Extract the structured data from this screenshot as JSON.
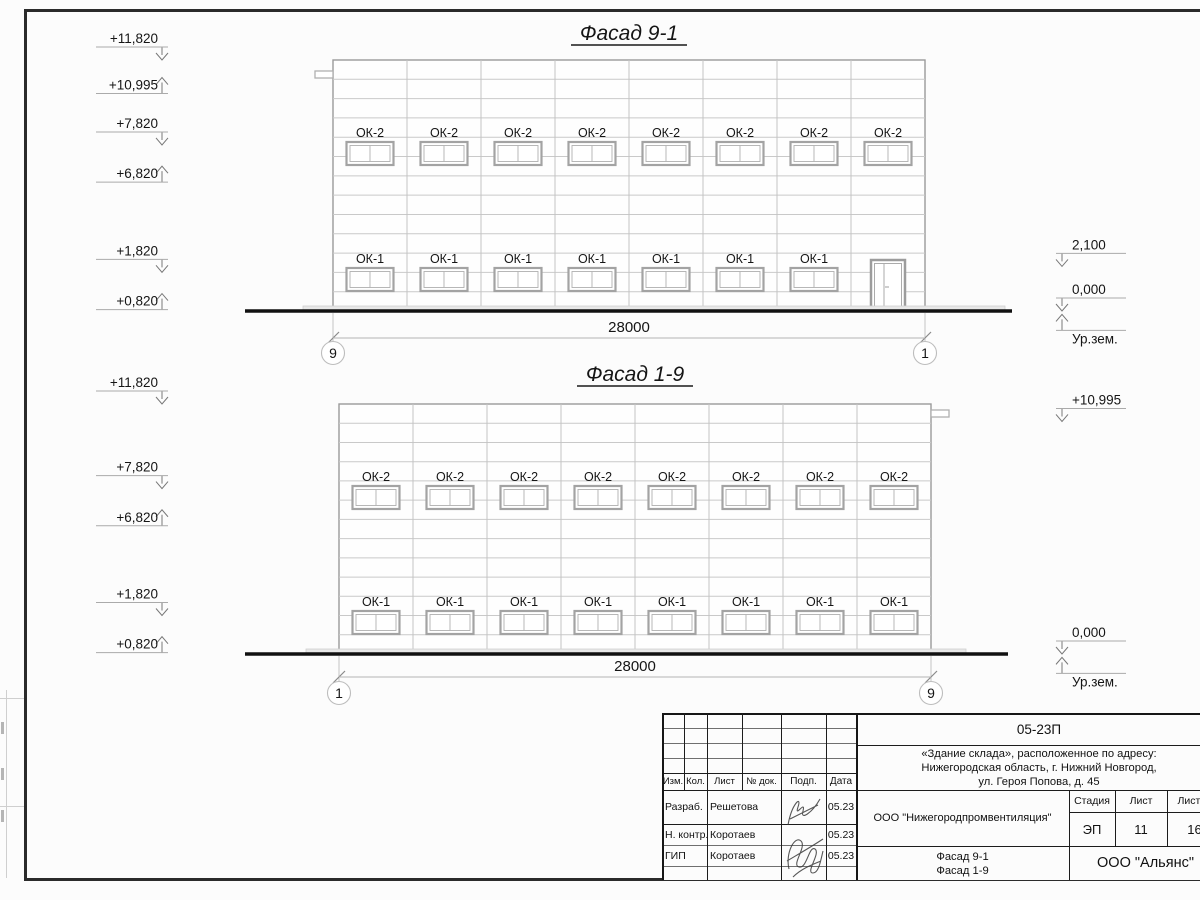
{
  "sheet": {
    "background": "#fcfcfc",
    "line_color": "#1c1c1c",
    "light_line_color": "#c9c9c9"
  },
  "facades": [
    {
      "title": "Фасад 9-1",
      "dimension": "28000",
      "axis_left": "9",
      "axis_right": "1",
      "bays": 8,
      "upper_window_label": "ОК-2",
      "upper_window_count": 8,
      "lower_window_label": "ОК-1",
      "lower_window_count": 7,
      "door_in_last_bay": true,
      "tab_side": "left",
      "levels_left": [
        {
          "text": "+11,820",
          "dir": "down",
          "mm": 11820
        },
        {
          "text": "+10,995",
          "dir": "up",
          "mm": 10995
        },
        {
          "text": "+7,820",
          "dir": "down",
          "mm": 7820
        },
        {
          "text": "+6,820",
          "dir": "up",
          "mm": 6820
        },
        {
          "text": "+1,820",
          "dir": "down",
          "mm": 1820
        },
        {
          "text": "+0,820",
          "dir": "up",
          "mm": 820
        }
      ],
      "levels_right": [
        {
          "text": "2,100",
          "dir": "down",
          "mm": 2100
        },
        {
          "text": "0,000",
          "dir": "down",
          "mm": 0
        },
        {
          "text": "Ур.зем.",
          "dir": "up",
          "mm": -160,
          "text_below": true
        }
      ]
    },
    {
      "title": "Фасад 1-9",
      "dimension": "28000",
      "axis_left": "1",
      "axis_right": "9",
      "bays": 8,
      "upper_window_label": "ОК-2",
      "upper_window_count": 8,
      "lower_window_label": "ОК-1",
      "lower_window_count": 8,
      "door_in_last_bay": false,
      "tab_side": "right",
      "levels_left": [
        {
          "text": "+11,820",
          "dir": "down",
          "mm": 11820
        },
        {
          "text": "+7,820",
          "dir": "down",
          "mm": 7820
        },
        {
          "text": "+6,820",
          "dir": "up",
          "mm": 6820
        },
        {
          "text": "+1,820",
          "dir": "down",
          "mm": 1820
        },
        {
          "text": "+0,820",
          "dir": "up",
          "mm": 820
        }
      ],
      "levels_right": [
        {
          "text": "+10,995",
          "dir": "down",
          "mm": 10995
        },
        {
          "text": "0,000",
          "dir": "down",
          "mm": 0
        },
        {
          "text": "Ур.зем.",
          "dir": "up",
          "mm": -160,
          "text_below": true
        }
      ]
    }
  ],
  "titleblock": {
    "doc_number": "05-23П",
    "address_line1": "«Здание склада», расположенное по адресу:",
    "address_line2": "Нижегородская область, г. Нижний Новгород,",
    "address_line3": "ул. Героя Попова, д. 45",
    "columns": [
      "Изм.",
      "Кол.",
      "Лист",
      "№ док.",
      "Подп.",
      "Дата"
    ],
    "rows": [
      {
        "role": "Разраб.",
        "name": "Решетова",
        "date": "05.23"
      },
      {
        "role": "Н. контр.",
        "name": "Коротаев",
        "date": "05.23"
      },
      {
        "role": "ГИП",
        "name": "Коротаев",
        "date": "05.23"
      }
    ],
    "organization": "ООО \"Нижегородпромвентиляция\"",
    "stage_label": "Стадия",
    "sheet_label": "Лист",
    "sheets_label": "Листов",
    "stage": "ЭП",
    "sheet": "11",
    "sheets": "16",
    "sheet_title_line1": "Фасад 9-1",
    "sheet_title_line2": "Фасад 1-9",
    "company": "ООО \"Альянс\""
  }
}
